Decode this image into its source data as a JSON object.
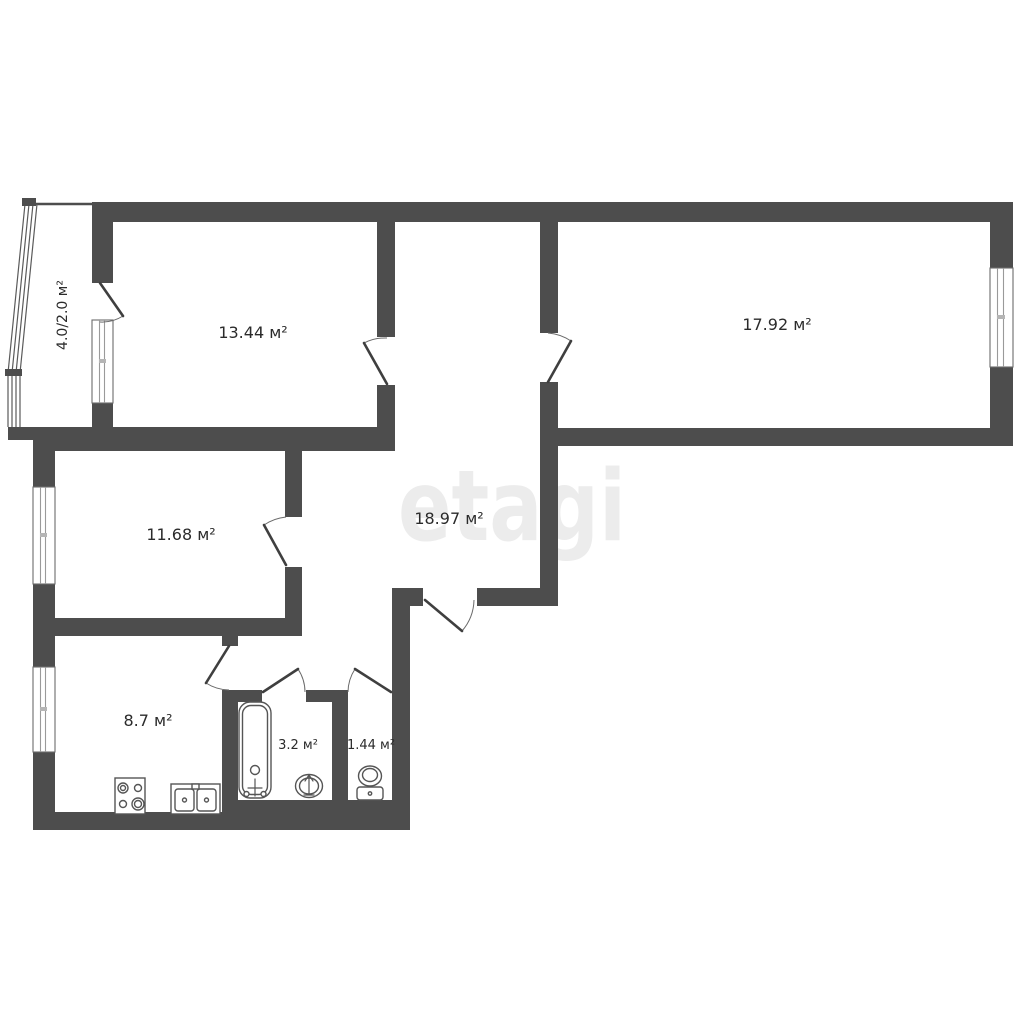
{
  "watermark": "etagi",
  "areas": [
    {
      "id": "balcony",
      "label": "4.0/2.0 м²"
    },
    {
      "id": "room-top-left",
      "label": "13.44 м²"
    },
    {
      "id": "room-top-right",
      "label": "17.92 м²"
    },
    {
      "id": "room-mid-left",
      "label": "11.68 м²"
    },
    {
      "id": "hallway",
      "label": "18.97 м²"
    },
    {
      "id": "kitchen",
      "label": "8.7 м²"
    },
    {
      "id": "bathroom",
      "label": "3.2 м²"
    },
    {
      "id": "wc",
      "label": "1.44 м²"
    }
  ],
  "colors": {
    "wall": "#4d4d4d",
    "fixture_line": "#555555",
    "watermark": "#ececec",
    "label": "#2b2b2b",
    "background": "#ffffff"
  }
}
